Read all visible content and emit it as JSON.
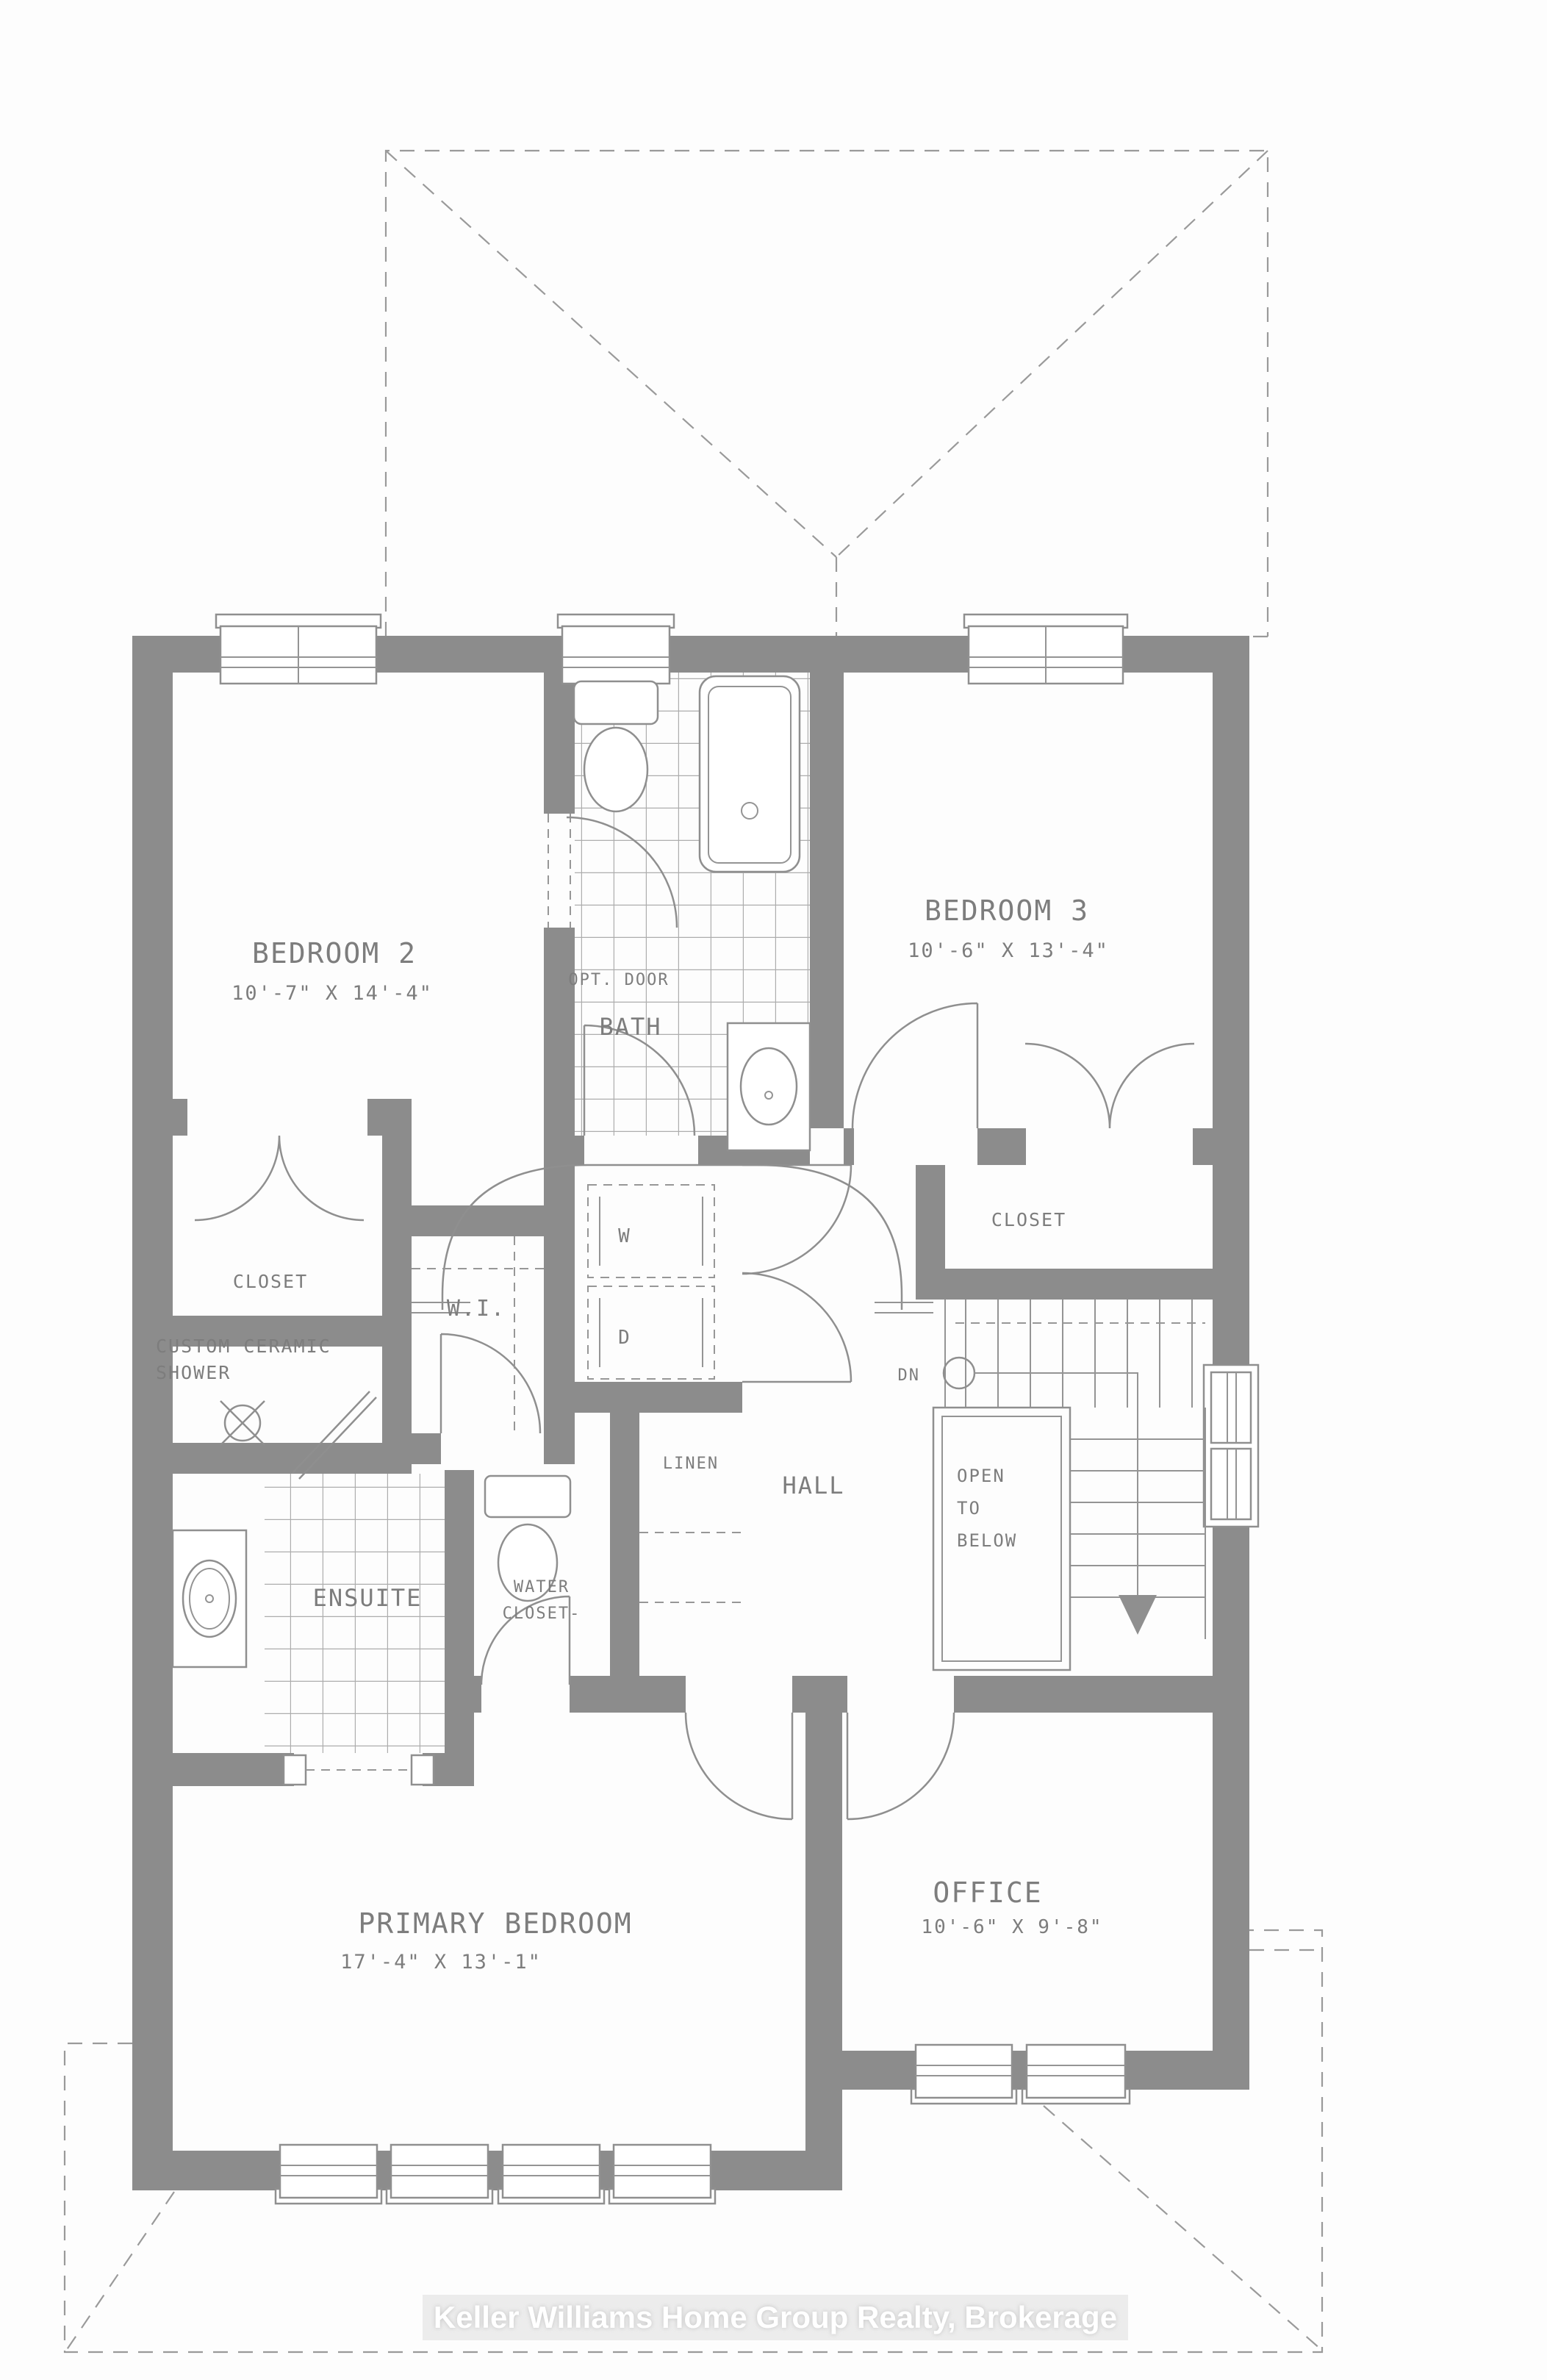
{
  "plan": {
    "rooms": {
      "bedroom2": {
        "name": "BEDROOM 2",
        "dims": "10'-7\" X 14'-4\""
      },
      "bedroom3": {
        "name": "BEDROOM 3",
        "dims": "10'-6\" X 13'-4\""
      },
      "bath": {
        "name": "BATH",
        "opt_door": "OPT. DOOR"
      },
      "closet_left": {
        "name": "CLOSET"
      },
      "closet_right": {
        "name": "CLOSET"
      },
      "shower": {
        "line1": "CUSTOM CERAMIC",
        "line2": "SHOWER"
      },
      "walk_in": {
        "name": "W.I."
      },
      "laundry": {
        "washer": "W",
        "dryer": "D"
      },
      "linen": {
        "name": "LINEN"
      },
      "water_closet": {
        "line1": "WATER",
        "line2": "CLOSET-"
      },
      "hall": {
        "name": "HALL"
      },
      "stairs": {
        "down": "DN"
      },
      "open_to_below": {
        "line1": "OPEN",
        "line2": "TO",
        "line3": "BELOW"
      },
      "ensuite": {
        "name": "ENSUITE"
      },
      "primary_bedroom": {
        "name": "PRIMARY BEDROOM",
        "dims": "17'-4\" X 13'-1\""
      },
      "office": {
        "name": "OFFICE",
        "dims": "10'-6\" X 9'-8\""
      }
    },
    "watermark": "Keller Williams Home Group Realty, Brokerage",
    "colors": {
      "wall": "#8c8c8c",
      "line": "#8f8f8f",
      "text": "#7d7d7d"
    }
  }
}
